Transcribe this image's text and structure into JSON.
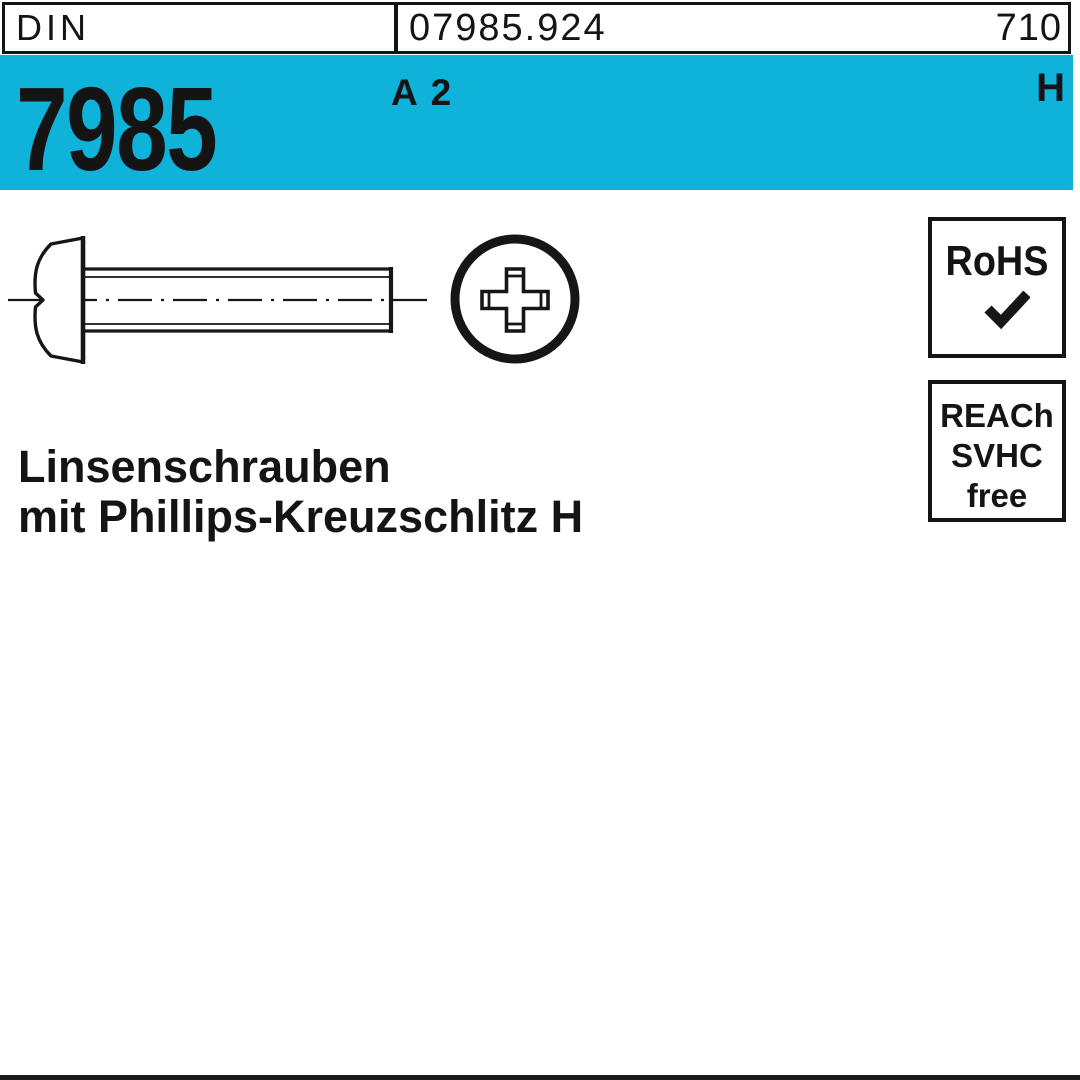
{
  "meta": {
    "card_type": "fastener catalog product card",
    "accent_color": "#0fb2d9",
    "line_color": "#161616"
  },
  "header": {
    "standard_org": "DIN",
    "article_number": "07985.924",
    "catalog_page": "710"
  },
  "banner": {
    "standard_number": "7985",
    "material_grade": "A 2",
    "drive_symbol": "H"
  },
  "drawing": {
    "views": [
      "screw side view with dash-dot centerline",
      "phillips recess front view"
    ]
  },
  "badges": {
    "rohs": {
      "title": "RoHS",
      "check_icon": "checkmark"
    },
    "reach": {
      "line1": "REACh",
      "line2": "SVHC",
      "line3": "free"
    }
  },
  "product": {
    "name_line1": "Linsenschrauben",
    "name_line2": "mit Phillips-Kreuzschlitz H"
  }
}
